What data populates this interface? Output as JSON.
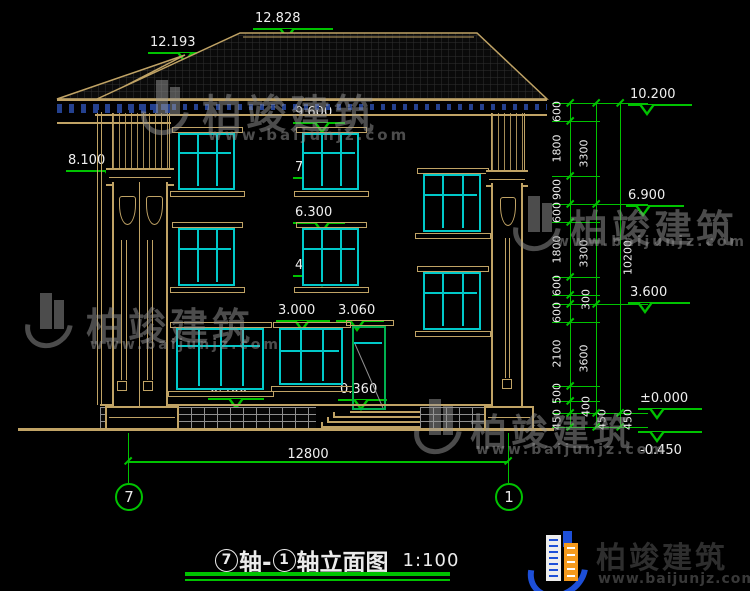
{
  "colors": {
    "tan": "#c0a365",
    "cyan": "#00c9c9",
    "green": "#00c300",
    "navy": "#24418f",
    "white": "#ebebeb",
    "watermark_gray": "#989898",
    "logo_blue": "#1d4fd8",
    "logo_orange": "#f59a1d",
    "door_green": "#00b050",
    "stone_gray": "#8f8f8f"
  },
  "title": {
    "axis_start": "7",
    "joiner": "轴-",
    "axis_end": "1",
    "suffix": "轴立面图",
    "scale": "1:100"
  },
  "brand": {
    "name": "柏竣建筑",
    "url": "www.baijunjz.com"
  },
  "bottom_dim": {
    "label": "12800",
    "y": 461,
    "x1": 128,
    "x2": 508,
    "label_x": 278,
    "label_y": 447
  },
  "axis_bubbles": [
    {
      "label": "7",
      "x": 128
    },
    {
      "label": "1",
      "x": 508
    }
  ],
  "elevation_markers": [
    {
      "label": "12.828",
      "lx": 253,
      "lw": 80,
      "y": 28,
      "cx": 287
    },
    {
      "label": "12.193",
      "lx": 148,
      "lw": 82,
      "y": 52,
      "cx": 185
    },
    {
      "label": "9.600",
      "lx": 293,
      "lw": 52,
      "y": 122,
      "cx": 322
    },
    {
      "label": "8.100",
      "lx": 66,
      "lw": 88,
      "y": 170,
      "cx": 112
    },
    {
      "label": "7.800",
      "lx": 293,
      "lw": 48,
      "y": 177,
      "cx": 317
    },
    {
      "label": "6.300",
      "lx": 293,
      "lw": 52,
      "y": 222,
      "cx": 322
    },
    {
      "label": "4.500",
      "lx": 293,
      "lw": 52,
      "y": 275,
      "cx": 322
    },
    {
      "label": "3.000",
      "lx": 276,
      "lw": 54,
      "y": 320,
      "cx": 302
    },
    {
      "label": "3.060",
      "lx": 336,
      "lw": 48,
      "y": 320,
      "cx": 357
    },
    {
      "label": "0.400",
      "lx": 208,
      "lw": 56,
      "y": 398,
      "cx": 236
    },
    {
      "label": "0.360",
      "lx": 338,
      "lw": 49,
      "y": 399,
      "cx": 361
    },
    {
      "label": "10.200",
      "lx": 628,
      "lw": 64,
      "y": 104,
      "cx": 647
    },
    {
      "label": "6.900",
      "lx": 626,
      "lw": 58,
      "y": 205,
      "cx": 643
    },
    {
      "label": "3.600",
      "lx": 628,
      "lw": 62,
      "y": 302,
      "cx": 645
    },
    {
      "label": "±0.000",
      "lx": 638,
      "lw": 64,
      "y": 408,
      "cx": 657
    },
    {
      "label": "-0.450",
      "lx": 638,
      "lw": 64,
      "y": 431,
      "cx": 657,
      "flip": true
    }
  ],
  "chains": {
    "levels": [
      103,
      121,
      176,
      204,
      222,
      277,
      295,
      304,
      322,
      386,
      401,
      413,
      427
    ],
    "majors": [
      103,
      204,
      304,
      413,
      427
    ],
    "cols": [
      {
        "x": 570,
        "label_x": 557,
        "segments": [
          [
            103,
            121,
            "600"
          ],
          [
            121,
            176,
            "1800"
          ],
          [
            176,
            204,
            "900"
          ],
          [
            204,
            222,
            "600"
          ],
          [
            222,
            277,
            "1800"
          ],
          [
            277,
            295,
            "600"
          ],
          [
            295,
            304,
            "300",
            586
          ],
          [
            304,
            322,
            "600"
          ],
          [
            322,
            386,
            "2100"
          ],
          [
            386,
            401,
            "500"
          ],
          [
            401,
            413,
            "400",
            586
          ],
          [
            413,
            427,
            "450"
          ]
        ]
      },
      {
        "x": 596,
        "label_x": 584,
        "segments": [
          [
            103,
            204,
            "3300"
          ],
          [
            204,
            304,
            "3300"
          ],
          [
            304,
            413,
            "3600"
          ],
          [
            413,
            427,
            "450",
            602
          ]
        ]
      },
      {
        "x": 620,
        "label_x": 628,
        "segments": [
          [
            103,
            413,
            "10200"
          ],
          [
            413,
            427,
            "450"
          ]
        ]
      }
    ]
  },
  "windows": [
    {
      "x": 178,
      "y": 133,
      "w": 57,
      "h": 57,
      "cols": 3,
      "transom": 0.34
    },
    {
      "x": 302,
      "y": 133,
      "w": 57,
      "h": 57,
      "cols": 3,
      "transom": 0.34
    },
    {
      "x": 178,
      "y": 228,
      "w": 57,
      "h": 58,
      "cols": 3,
      "transom": 0.34
    },
    {
      "x": 302,
      "y": 228,
      "w": 57,
      "h": 58,
      "cols": 3,
      "transom": 0.34
    },
    {
      "x": 423,
      "y": 174,
      "w": 58,
      "h": 58,
      "cols": 3,
      "transom": 0.34
    },
    {
      "x": 423,
      "y": 272,
      "w": 58,
      "h": 58,
      "cols": 3,
      "transom": 0.34
    },
    {
      "x": 176,
      "y": 328,
      "w": 88,
      "h": 62,
      "cols": 4,
      "transom": 0.27
    },
    {
      "x": 279,
      "y": 328,
      "w": 64,
      "h": 57,
      "cols": 3,
      "transom": 0.38
    }
  ],
  "door": {
    "x": 352,
    "y": 326,
    "w": 34,
    "h": 84,
    "transom": 0.19
  },
  "steps": {
    "platform": [
      350,
      411,
      70
    ],
    "treads": [
      [
        333,
        416,
        87
      ],
      [
        327,
        421,
        93
      ],
      [
        321,
        426,
        99
      ]
    ]
  },
  "watermarks": [
    {
      "x": 140,
      "y": 78,
      "tx": 202,
      "ty": 82,
      "fs": 40,
      "ux": 208,
      "uy": 126,
      "ufs": 15
    },
    {
      "x": 24,
      "y": 291,
      "tx": 86,
      "ty": 296,
      "fs": 38,
      "ux": 90,
      "uy": 337,
      "ufs": 14
    },
    {
      "x": 512,
      "y": 194,
      "tx": 570,
      "ty": 198,
      "fs": 38,
      "ux": 556,
      "uy": 234,
      "ufs": 14
    },
    {
      "x": 413,
      "y": 397,
      "tx": 470,
      "ty": 402,
      "fs": 37,
      "ux": 476,
      "uy": 442,
      "ufs": 14
    }
  ]
}
